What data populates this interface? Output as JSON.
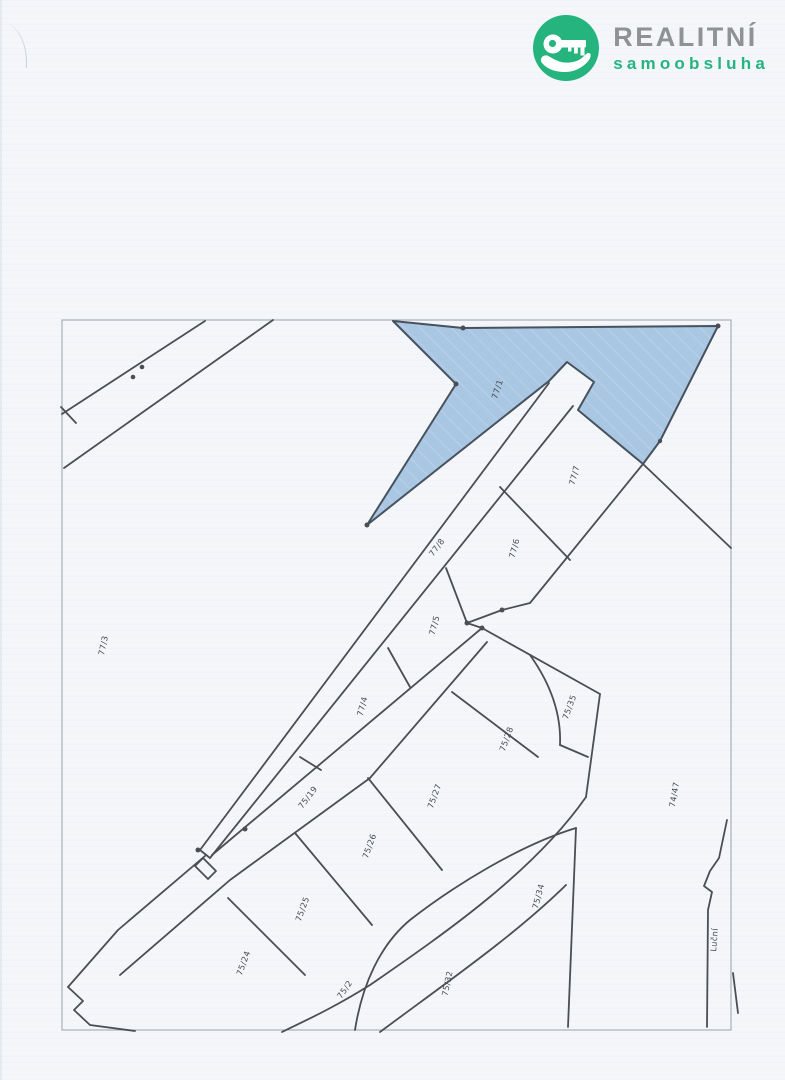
{
  "logo": {
    "brand_top": "REALITNÍ",
    "brand_bottom": "samoobsluha",
    "accent_green": "#25b47e",
    "brand_gray": "#8f9295"
  },
  "map": {
    "highlight_fill": "#a9c6e3",
    "line_color": "#4b4e54",
    "frame_color": "#abb0b6",
    "highlighted_parcel": "77/1",
    "parcels": [
      {
        "label": "77/1",
        "x": 500,
        "y": 390,
        "rot": -72,
        "highlighted": true
      },
      {
        "label": "77/7",
        "x": 577,
        "y": 476,
        "rot": -75,
        "highlighted": false
      },
      {
        "label": "77/6",
        "x": 517,
        "y": 549,
        "rot": -75,
        "highlighted": false
      },
      {
        "label": "77/8",
        "x": 439,
        "y": 549,
        "rot": -53,
        "highlighted": false
      },
      {
        "label": "77/5",
        "x": 437,
        "y": 626,
        "rot": -75,
        "highlighted": false
      },
      {
        "label": "77/4",
        "x": 365,
        "y": 707,
        "rot": -75,
        "highlighted": false
      },
      {
        "label": "77/3",
        "x": 106,
        "y": 646,
        "rot": -78,
        "highlighted": false
      },
      {
        "label": "75/19",
        "x": 310,
        "y": 799,
        "rot": -53,
        "highlighted": false
      },
      {
        "label": "75/35",
        "x": 572,
        "y": 708,
        "rot": -70,
        "highlighted": false
      },
      {
        "label": "75/28",
        "x": 509,
        "y": 740,
        "rot": -70,
        "highlighted": false
      },
      {
        "label": "75/27",
        "x": 437,
        "y": 797,
        "rot": -70,
        "highlighted": false
      },
      {
        "label": "75/26",
        "x": 372,
        "y": 847,
        "rot": -70,
        "highlighted": false
      },
      {
        "label": "75/25",
        "x": 305,
        "y": 910,
        "rot": -70,
        "highlighted": false
      },
      {
        "label": "75/24",
        "x": 246,
        "y": 964,
        "rot": -70,
        "highlighted": false
      },
      {
        "label": "75/34",
        "x": 541,
        "y": 897,
        "rot": -75,
        "highlighted": false
      },
      {
        "label": "75/32",
        "x": 450,
        "y": 984,
        "rot": -78,
        "highlighted": false
      },
      {
        "label": "75/2",
        "x": 347,
        "y": 991,
        "rot": -55,
        "highlighted": false
      },
      {
        "label": "74/47",
        "x": 677,
        "y": 795,
        "rot": -80,
        "highlighted": false
      }
    ],
    "street_labels": [
      {
        "label": "Luční",
        "x": 717,
        "y": 940,
        "rot": -86
      }
    ]
  }
}
